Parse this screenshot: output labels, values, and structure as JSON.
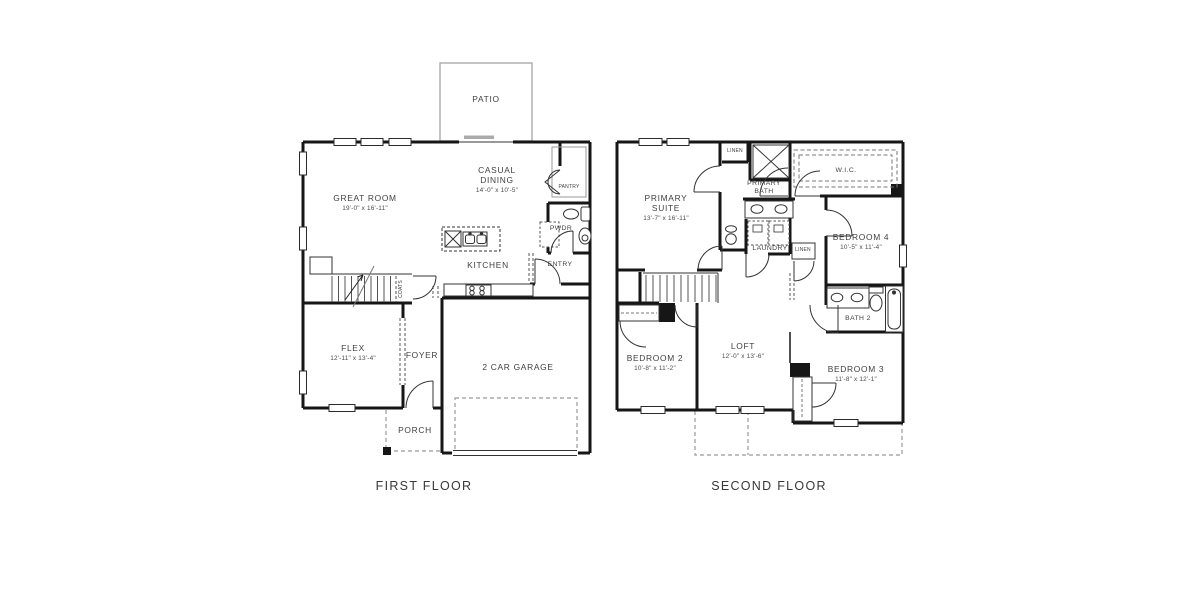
{
  "plan": {
    "first": {
      "title": "FIRST FLOOR",
      "rooms": {
        "patio": {
          "name": "PATIO"
        },
        "great_room": {
          "name": "GREAT ROOM",
          "dims": "19'-0\" x 16'-11\""
        },
        "casual_dining": {
          "line1": "CASUAL",
          "line2": "DINING",
          "dims": "14'-0\" x 10'-5\""
        },
        "pantry": {
          "name": "PANTRY"
        },
        "pwdr": {
          "name": "PWDR"
        },
        "kitchen": {
          "name": "KITCHEN"
        },
        "entry": {
          "name": "ENTRY"
        },
        "coats": {
          "name": "COATS"
        },
        "flex": {
          "name": "FLEX",
          "dims": "12'-11\" x 13'-4\""
        },
        "foyer": {
          "name": "FOYER"
        },
        "garage": {
          "name": "2 CAR GARAGE"
        },
        "porch": {
          "name": "PORCH"
        }
      }
    },
    "second": {
      "title": "SECOND FLOOR",
      "rooms": {
        "primary_suite": {
          "line1": "PRIMARY",
          "line2": "SUITE",
          "dims": "13'-7\" x 16'-11\""
        },
        "linen_upper": {
          "name": "LINEN"
        },
        "primary_bath": {
          "line1": "PRIMARY",
          "line2": "BATH"
        },
        "wic": {
          "name": "W.I.C."
        },
        "bedroom4": {
          "name": "BEDROOM 4",
          "dims": "10'-5\" x 11'-4\""
        },
        "laundry": {
          "name": "LAUNDRY"
        },
        "linen_hall": {
          "name": "LINEN"
        },
        "bedroom2": {
          "name": "BEDROOM 2",
          "dims": "10'-8\" x 11'-2\""
        },
        "loft": {
          "name": "LOFT",
          "dims": "12'-0\" x 13'-6\""
        },
        "bath2": {
          "name": "BATH 2"
        },
        "bedroom3": {
          "name": "BEDROOM 3",
          "dims": "11'-8\" x 12'-1\""
        }
      }
    }
  },
  "colors": {
    "wall": "#161616",
    "thin": "#333333",
    "site": "#9a9a9a",
    "label": "#3f3f3f"
  }
}
